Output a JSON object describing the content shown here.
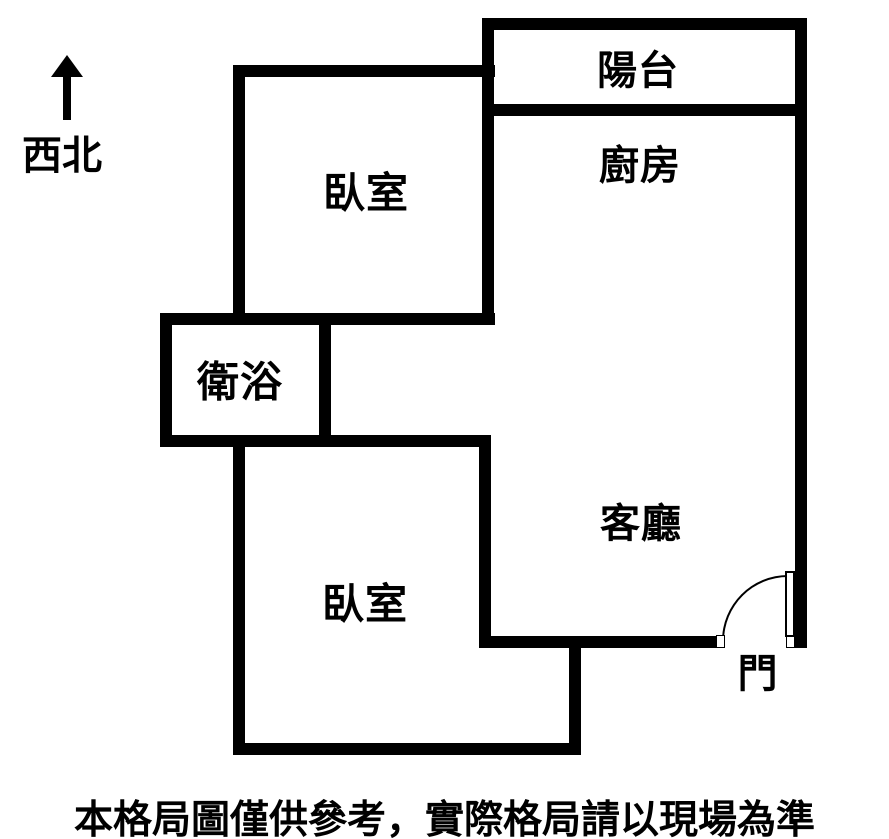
{
  "colors": {
    "wall": "#000000",
    "background": "#ffffff",
    "text": "#000000"
  },
  "compass": {
    "label": "西北"
  },
  "rooms": {
    "balcony": {
      "label": "陽台"
    },
    "kitchen": {
      "label": "廚房"
    },
    "bedroom_top": {
      "label": "臥室"
    },
    "bathroom": {
      "label": "衛浴"
    },
    "living_room": {
      "label": "客廳"
    },
    "bedroom_bottom": {
      "label": "臥室"
    },
    "entry_door": {
      "label": "門"
    }
  },
  "disclaimer": "本格局圖僅供參考，實際格局請以現場為準"
}
